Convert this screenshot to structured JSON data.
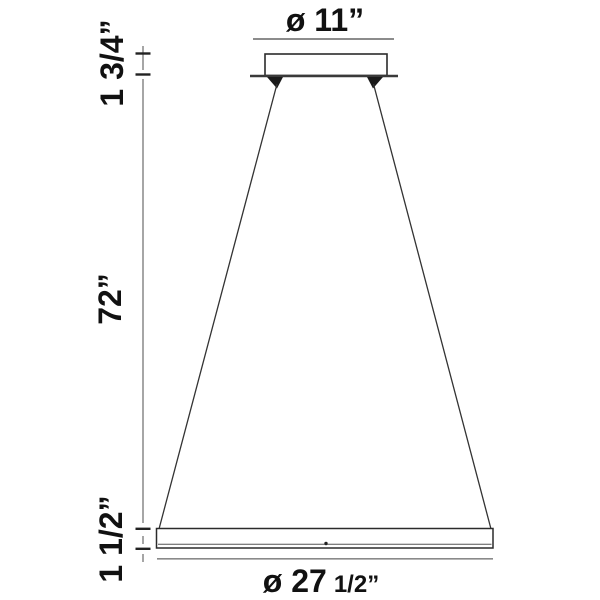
{
  "diagram": {
    "type": "pendant-light-dimension-drawing",
    "dimensions": {
      "canopy_diameter": "ø 11”",
      "canopy_height": "1 3/4”",
      "suspension_length": "72”",
      "ring_height": "1 1/2”",
      "ring_diameter_main": "ø 27",
      "ring_diameter_fraction": "1/2”"
    },
    "colors": {
      "outline": "#2b2b2b",
      "dim_line_gray": "#777777",
      "flange": "#3a3a3a",
      "text": "#111111",
      "background": "#ffffff"
    }
  }
}
